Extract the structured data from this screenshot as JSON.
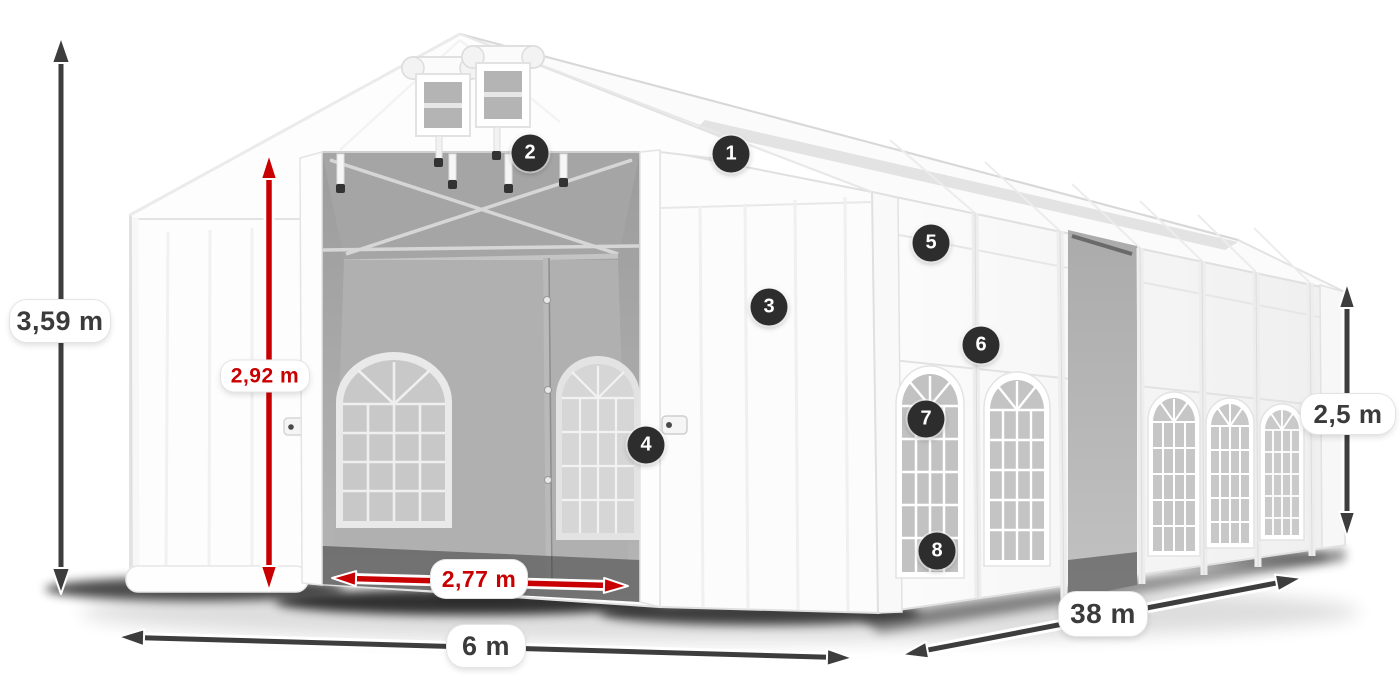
{
  "diagram": {
    "labels": {
      "total_height": "3,59 m",
      "entrance_height": "2,92 m",
      "entrance_width": "2,77 m",
      "tent_width": "6 m",
      "tent_length": "38 m",
      "side_height": "2,5 m"
    },
    "callouts": {
      "c1": "1",
      "c2": "2",
      "c3": "3",
      "c4": "4",
      "c5": "5",
      "c6": "6",
      "c7": "7",
      "c8": "8"
    },
    "colors": {
      "arrow_dark": "#3d3d3d",
      "arrow_red": "#c90001",
      "label_background": "#ffffff",
      "label_text_dark": "#3b3b3b",
      "label_text_red": "#c90001",
      "badge_background": "#2d2d2d",
      "badge_number": "#ffffff",
      "tent_white": "#fbfbfb",
      "interior_gray": "#a8a8a8"
    }
  }
}
